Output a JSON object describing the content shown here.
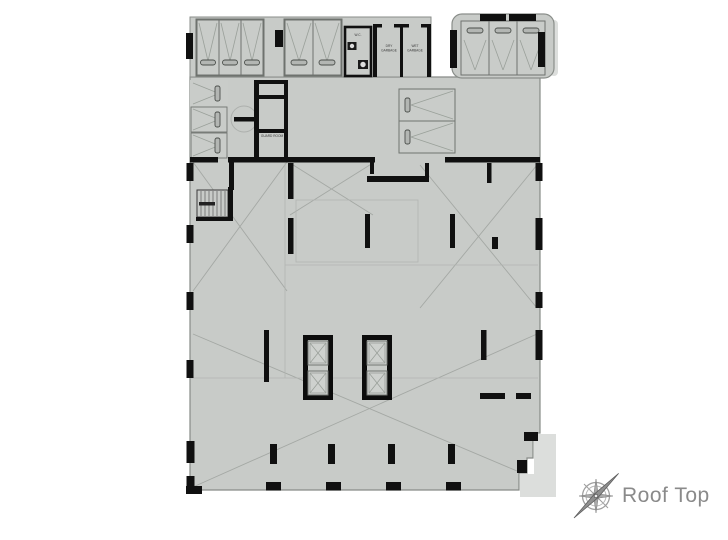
{
  "drawing": {
    "floor_label": "Roof Top",
    "rooms": {
      "wc": "W.C.",
      "dry_garbage_line1": "DRY",
      "dry_garbage_line2": "GARBAGE",
      "wet_garbage_line1": "WET",
      "wet_garbage_line2": "GARBAGE",
      "guard_room": "GUARD ROOM"
    },
    "icons": {
      "compass": "compass-rose-icon"
    },
    "colors": {
      "floor_fill": "#c8cbc8",
      "wall": "#101010",
      "hatch_line": "#a4a8a4",
      "shadow": "#dcdedc",
      "title_text": "#8a8a8a"
    }
  }
}
